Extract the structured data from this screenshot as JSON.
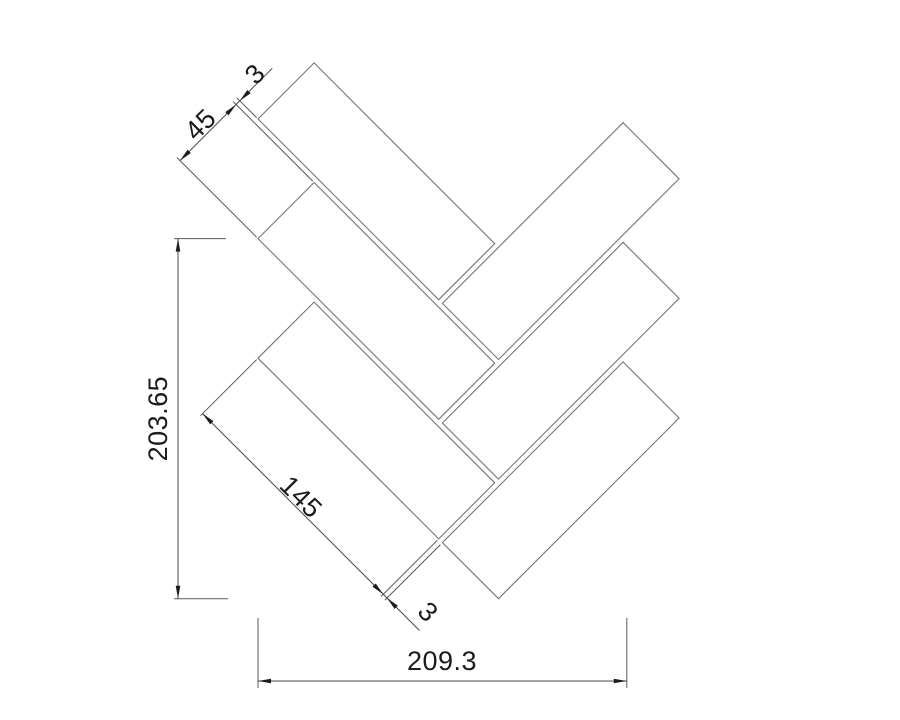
{
  "drawing": {
    "canvas": {
      "width": 900,
      "height": 720,
      "background": "#ffffff"
    },
    "colors": {
      "tile_stroke": "#757575",
      "dim_stroke": "#4a4a4a",
      "ext_stroke": "#5a5a5a",
      "arrow_fill": "#1c1c1c",
      "text_color": "#1c1c1c"
    },
    "text_size": 27,
    "tiles": [
      {
        "name": "tile-left-1",
        "points": [
          [
            258,
            119
          ],
          [
            314.1,
            62.9
          ],
          [
            494.7,
            243.6
          ],
          [
            438.7,
            299.7
          ]
        ]
      },
      {
        "name": "tile-left-2",
        "points": [
          [
            258,
            238.6
          ],
          [
            314.1,
            182.5
          ],
          [
            494.7,
            363.2
          ],
          [
            438.7,
            419.3
          ]
        ]
      },
      {
        "name": "tile-left-3",
        "points": [
          [
            258,
            358.2
          ],
          [
            314.1,
            302.1
          ],
          [
            494.7,
            482.8
          ],
          [
            438.7,
            538.9
          ]
        ]
      },
      {
        "name": "tile-right-1",
        "points": [
          [
            442.4,
            303.4
          ],
          [
            623.1,
            122.7
          ],
          [
            679.1,
            178.8
          ],
          [
            498.5,
            359.5
          ]
        ]
      },
      {
        "name": "tile-right-2",
        "points": [
          [
            442.4,
            423.0
          ],
          [
            623.1,
            242.3
          ],
          [
            679.1,
            298.4
          ],
          [
            498.5,
            479.1
          ]
        ]
      },
      {
        "name": "tile-right-3",
        "points": [
          [
            442.4,
            542.6
          ],
          [
            623.1,
            361.9
          ],
          [
            679.1,
            418.0
          ],
          [
            498.5,
            598.7
          ]
        ]
      }
    ],
    "dim_lines": [
      {
        "name": "dim-line-tile-width",
        "x1": 180,
        "y1": 160.6,
        "x2": 272.3,
        "y2": 68.3
      },
      {
        "name": "dim-line-tile-length",
        "x1": 202.6,
        "y1": 413.6,
        "x2": 419.5,
        "y2": 630.5
      },
      {
        "name": "dim-line-overall-height",
        "x1": 178,
        "y1": 238.6,
        "x2": 178,
        "y2": 598.7
      },
      {
        "name": "dim-line-overall-width",
        "x1": 258,
        "y1": 681,
        "x2": 626.8,
        "y2": 681
      }
    ],
    "ext_lines": [
      {
        "name": "ext-width-start",
        "x1": 256.6,
        "y1": 237.2,
        "x2": 177,
        "y2": 157.6
      },
      {
        "name": "ext-width-end",
        "x1": 312.7,
        "y1": 181.1,
        "x2": 233.1,
        "y2": 101.5
      },
      {
        "name": "ext-gap-top",
        "x1": 256.6,
        "y1": 117.6,
        "x2": 236.8,
        "y2": 97.8
      },
      {
        "name": "ext-length-start",
        "x1": 256.6,
        "y1": 359.6,
        "x2": 200.5,
        "y2": 415.7
      },
      {
        "name": "ext-length-end",
        "x1": 437.3,
        "y1": 540.3,
        "x2": 381.2,
        "y2": 596.4
      },
      {
        "name": "ext-gap-bottom",
        "x1": 440.4,
        "y1": 544.6,
        "x2": 384.9,
        "y2": 600.1
      },
      {
        "name": "ext-height-top",
        "x1": 174,
        "y1": 238.6,
        "x2": 226,
        "y2": 238.6
      },
      {
        "name": "ext-height-bottom",
        "x1": 174,
        "y1": 598.7,
        "x2": 228,
        "y2": 598.7
      },
      {
        "name": "ext-overall-left",
        "x1": 258,
        "y1": 618,
        "x2": 258,
        "y2": 688
      },
      {
        "name": "ext-overall-right",
        "x1": 626.8,
        "y1": 618,
        "x2": 626.8,
        "y2": 688
      }
    ],
    "arrows": [
      {
        "name": "arrow-width-sw",
        "tip": [
          180,
          160.6
        ],
        "dir": [
          -0.7071,
          0.7071
        ]
      },
      {
        "name": "arrow-width-ne",
        "tip": [
          236.1,
          104.5
        ],
        "dir": [
          0.7071,
          -0.7071
        ]
      },
      {
        "name": "arrow-gap-top",
        "tip": [
          239.8,
          100.8
        ],
        "dir": [
          -0.7071,
          0.7071
        ]
      },
      {
        "name": "arrow-length-nw",
        "tip": [
          202.6,
          413.6
        ],
        "dir": [
          -0.7071,
          -0.7071
        ]
      },
      {
        "name": "arrow-length-se",
        "tip": [
          383.3,
          594.3
        ],
        "dir": [
          0.7071,
          0.7071
        ]
      },
      {
        "name": "arrow-gap-bottom",
        "tip": [
          387.0,
          598.0
        ],
        "dir": [
          -0.7071,
          -0.7071
        ]
      },
      {
        "name": "arrow-height-top",
        "tip": [
          178,
          238.6
        ],
        "dir": [
          0,
          -1
        ]
      },
      {
        "name": "arrow-height-bottom",
        "tip": [
          178,
          598.7
        ],
        "dir": [
          0,
          1
        ]
      },
      {
        "name": "arrow-overall-left",
        "tip": [
          258,
          681
        ],
        "dir": [
          -1,
          0
        ]
      },
      {
        "name": "arrow-overall-right",
        "tip": [
          626.8,
          681
        ],
        "dir": [
          1,
          0
        ]
      }
    ],
    "labels": [
      {
        "name": "tile-width-label",
        "text": "45",
        "x": 200.5,
        "y": 124.5,
        "rot": -45
      },
      {
        "name": "top-gap-label",
        "text": "3",
        "x": 255,
        "y": 74,
        "rot": -45
      },
      {
        "name": "tile-length-label",
        "text": "145",
        "x": 301,
        "y": 497,
        "rot": 45
      },
      {
        "name": "bottom-gap-label",
        "text": "3",
        "x": 428,
        "y": 612,
        "rot": 45
      },
      {
        "name": "overall-height-label",
        "text": "203.65",
        "x": 158,
        "y": 418.6,
        "rot": -90
      },
      {
        "name": "overall-width-label",
        "text": "209.3",
        "x": 442,
        "y": 661,
        "rot": 0
      }
    ]
  }
}
